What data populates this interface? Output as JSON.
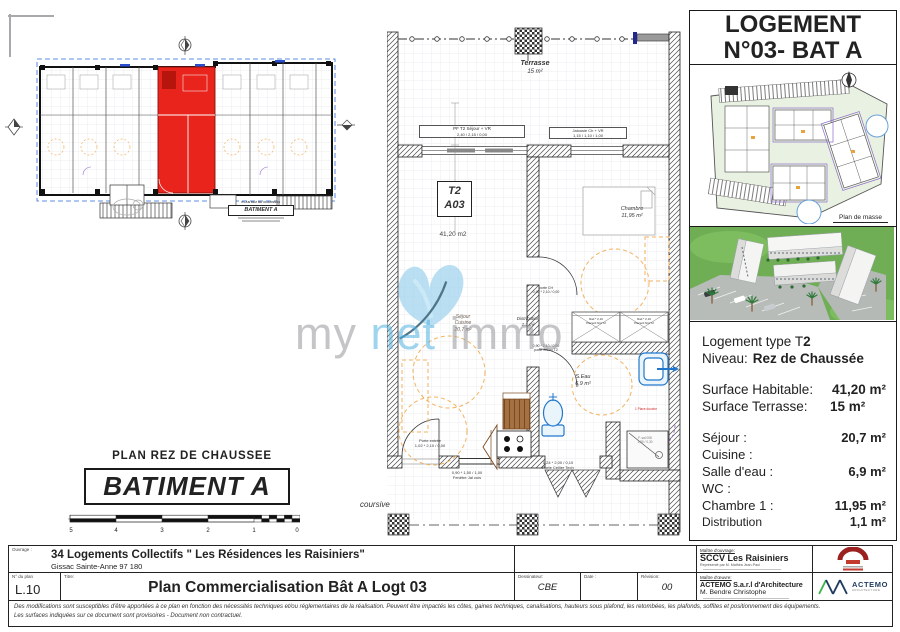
{
  "overview": {
    "heading": "PLAN REZ DE CHAUSSEE",
    "building_box": "BATIMENT A",
    "mini_heading": "PLAN REZ DE CHAUSSEE",
    "mini_building": "BATIMENT A",
    "scale_ticks": [
      "5",
      "4",
      "3",
      "2",
      "1",
      "0"
    ]
  },
  "floor_plan": {
    "terrace": {
      "name": "Terrasse",
      "area": "15 m²"
    },
    "unit": {
      "type": "T2",
      "number": "A03",
      "area": "41,20 m2"
    },
    "rooms": {
      "sejour": {
        "line1": "Séjour",
        "line2": "Cuisine",
        "area": "20,7 m²"
      },
      "chambre": {
        "name": "Chambre",
        "area": "11,95 m²"
      },
      "distribution": {
        "name": "Distribution",
        "area": "1,1 m²"
      },
      "salle_eau": {
        "name": "S.Eau",
        "area": "6,9 m²"
      }
    },
    "openings": {
      "win_sejour": {
        "label": "PF T2 Séjour + VR",
        "dims": "2,40 / 2,15 / 0,00"
      },
      "win_chambre": {
        "label": "Jalousie Ch + VR",
        "dims": "1,15 / 1,10 / 1,00"
      },
      "porte_ch": {
        "label": "porte CH",
        "dims": "0,90 * 2,10 / 0,00"
      },
      "porte_seau": {
        "dims": "0,90 * 2,10 / 0,00",
        "label": "porte S.Eau T2"
      },
      "porte_entree": {
        "label": "Porte entrée",
        "dims": "1,02 * 2,10 / 0,00"
      },
      "fenetre_cuisine": {
        "dims": "0,90 * 1,50 / 1,00",
        "label": "Fenêtre Jal cuis"
      },
      "porte_cellier": {
        "dims": "1,24 * 2,00 / 0,10",
        "label": "Porte Cellier Tech"
      }
    },
    "closet": {
      "line1": "Rail * 2,10",
      "line2": "Placard Nid T2"
    },
    "shower_note": "F. sal 008",
    "shower_note2": "1,80 / 0,30",
    "douche_flag": "1 Place douche",
    "coursive": "coursive",
    "watermark": {
      "part1": "my ",
      "part2": "net",
      "part3": " immo"
    }
  },
  "side_panel": {
    "title_line1": "LOGEMENT",
    "title_line2": "N°03- BAT A",
    "plan_masse_caption": "Plan de masse",
    "details": {
      "type_label": "Logement type T",
      "type_value": "2",
      "level_label": "Niveau:",
      "level_value": "Rez de Chaussée",
      "surface_hab_label": "Surface Habitable:",
      "surface_hab_value": "41,20 m²",
      "surface_ter_label": "Surface Terrasse:",
      "surface_ter_value": "15 m²",
      "rows": [
        {
          "label": "Séjour :",
          "value": "20,7 m²"
        },
        {
          "label": "Cuisine :",
          "value": ""
        },
        {
          "label": "Salle d'eau :",
          "value": "6,9 m²"
        },
        {
          "label": "WC :",
          "value": ""
        },
        {
          "label": "Chambre 1 :",
          "value": "11,95 m²"
        },
        {
          "label": "Distribution",
          "value": "1,1 m²"
        }
      ]
    }
  },
  "title_block": {
    "ouvrage_label": "Ouvrage :",
    "project_name": "34 Logements Collectifs \" Les Résidences les Raisiniers\"",
    "project_location": "Gissac Sainte-Anne 97 180",
    "plan_number_label": "N° du plan",
    "plan_number": "L.10",
    "title_label": "Titre:",
    "title": "Plan Commercialisation Bât A Logt 03",
    "drafter_label": "Dessinateur:",
    "drafter": "CBE",
    "date_label": "Date :",
    "revision_label": "Révision:",
    "revision": "00",
    "owner_label": "Maître d'ouvrage:",
    "owner_name": "SCCV Les Raisiniers",
    "owner_rep": "Représenté par M. Mathéa Jean-Paul",
    "architect_label": "Maître d'œuvre:",
    "architect_name": "ACTEMO S.a.r.l d'Architecture",
    "architect_person": "M. Bendre Christophe",
    "actemo_logo_text": "ACTEMO",
    "actemo_logo_sub": "ARCHITECTURE",
    "disclaimer_1": "Des modifications sont susceptibles d'être apportées à ce plan en fonction des nécessités techniques et/ou réglementaires de la réalisation. Peuvent être impactés les côtes, gaines techniques, canalisations, hauteurs sous plafond, les retombées, les plafonds, soffites et positionnement des équipements.",
    "disclaimer_2": "Les surfaces indiquées sur ce document sont provisoires - Document non contractuel."
  }
}
